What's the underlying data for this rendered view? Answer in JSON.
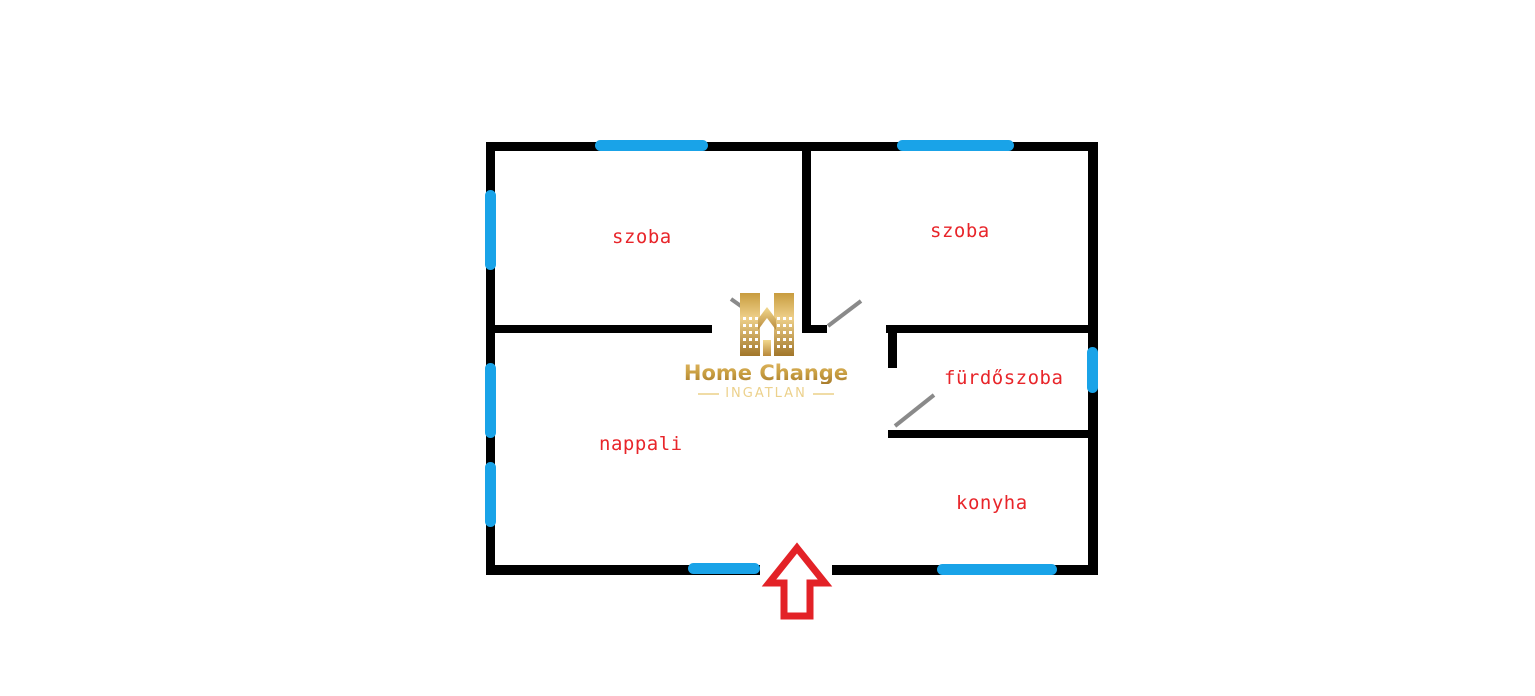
{
  "diagram": {
    "type": "floor-plan",
    "rooms": [
      {
        "id": "szoba-1",
        "label": "szoba",
        "position": "top-left"
      },
      {
        "id": "szoba-2",
        "label": "szoba",
        "position": "top-right"
      },
      {
        "id": "furdoszoba",
        "label": "fürdőszoba",
        "position": "middle-right"
      },
      {
        "id": "nappali",
        "label": "nappali",
        "position": "bottom-left"
      },
      {
        "id": "konyha",
        "label": "konyha",
        "position": "bottom-right"
      }
    ],
    "windows": [
      {
        "wall": "top",
        "room": "szoba-1"
      },
      {
        "wall": "top",
        "room": "szoba-2"
      },
      {
        "wall": "left",
        "room": "szoba-1"
      },
      {
        "wall": "left",
        "room": "nappali"
      },
      {
        "wall": "left",
        "room": "nappali"
      },
      {
        "wall": "bottom",
        "room": "nappali"
      },
      {
        "wall": "bottom",
        "room": "konyha"
      },
      {
        "wall": "right",
        "room": "furdoszoba"
      }
    ],
    "doors": [
      {
        "room": "szoba-1",
        "type": "swing"
      },
      {
        "room": "szoba-2",
        "type": "swing"
      },
      {
        "room": "furdoszoba",
        "type": "swing"
      },
      {
        "room": "entrance",
        "type": "opening-with-arrow",
        "wall": "bottom"
      }
    ],
    "colors": {
      "wall": "#000000",
      "window": "#19a3e8",
      "label": "#e8252a",
      "swing": "#8a8a8a",
      "arrow": "#e32227"
    }
  },
  "logo": {
    "title": "Home Change",
    "subtitle": "INGATLAN",
    "icon": "gold-buildings-house-icon"
  }
}
